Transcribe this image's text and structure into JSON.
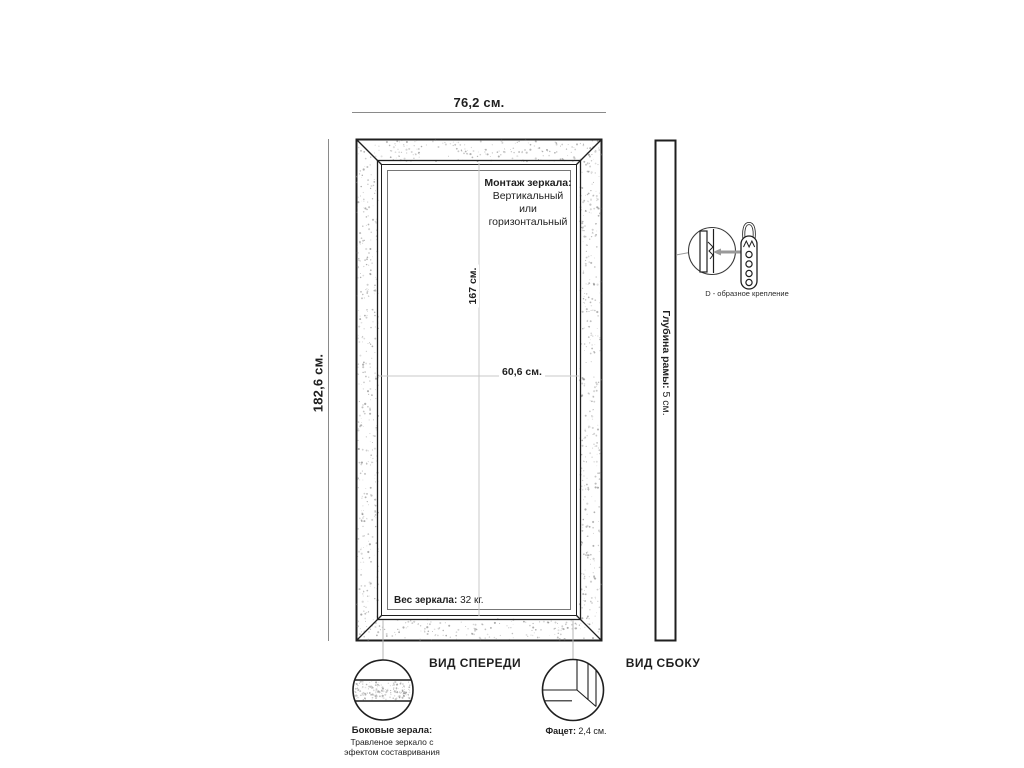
{
  "front_view": {
    "width_label": "76,2 см.",
    "height_label": "182,6 см.",
    "inner_height_label": "167 см.",
    "inner_width_label": "60,6 см.",
    "mount_title": "Монтаж зеркала:",
    "mount_line1": "Вертикальный",
    "mount_line2": "или",
    "mount_line3": "горизонтальный",
    "weight_title": "Вес зеркала:",
    "weight_value": "32 кг.",
    "caption": "ВИД СПЕРЕДИ"
  },
  "side_view": {
    "depth_title": "Глубина рамы:",
    "depth_value": "5 см.",
    "caption": "ВИД СБОКУ"
  },
  "bracket": {
    "label": "D - образное крепление"
  },
  "details": {
    "side_mirror_title": "Боковые зерала:",
    "side_mirror_line1": "Травленое зеркало с",
    "side_mirror_line2": "эфектом составривания",
    "facet_title": "Фацет:",
    "facet_value": "2,4 см."
  },
  "colors": {
    "line": "#1f1f1f",
    "dim_line": "#8a8a8a",
    "center_line": "#c9c9c9",
    "speckle": "#8a8a8a",
    "arrow": "#999999"
  }
}
